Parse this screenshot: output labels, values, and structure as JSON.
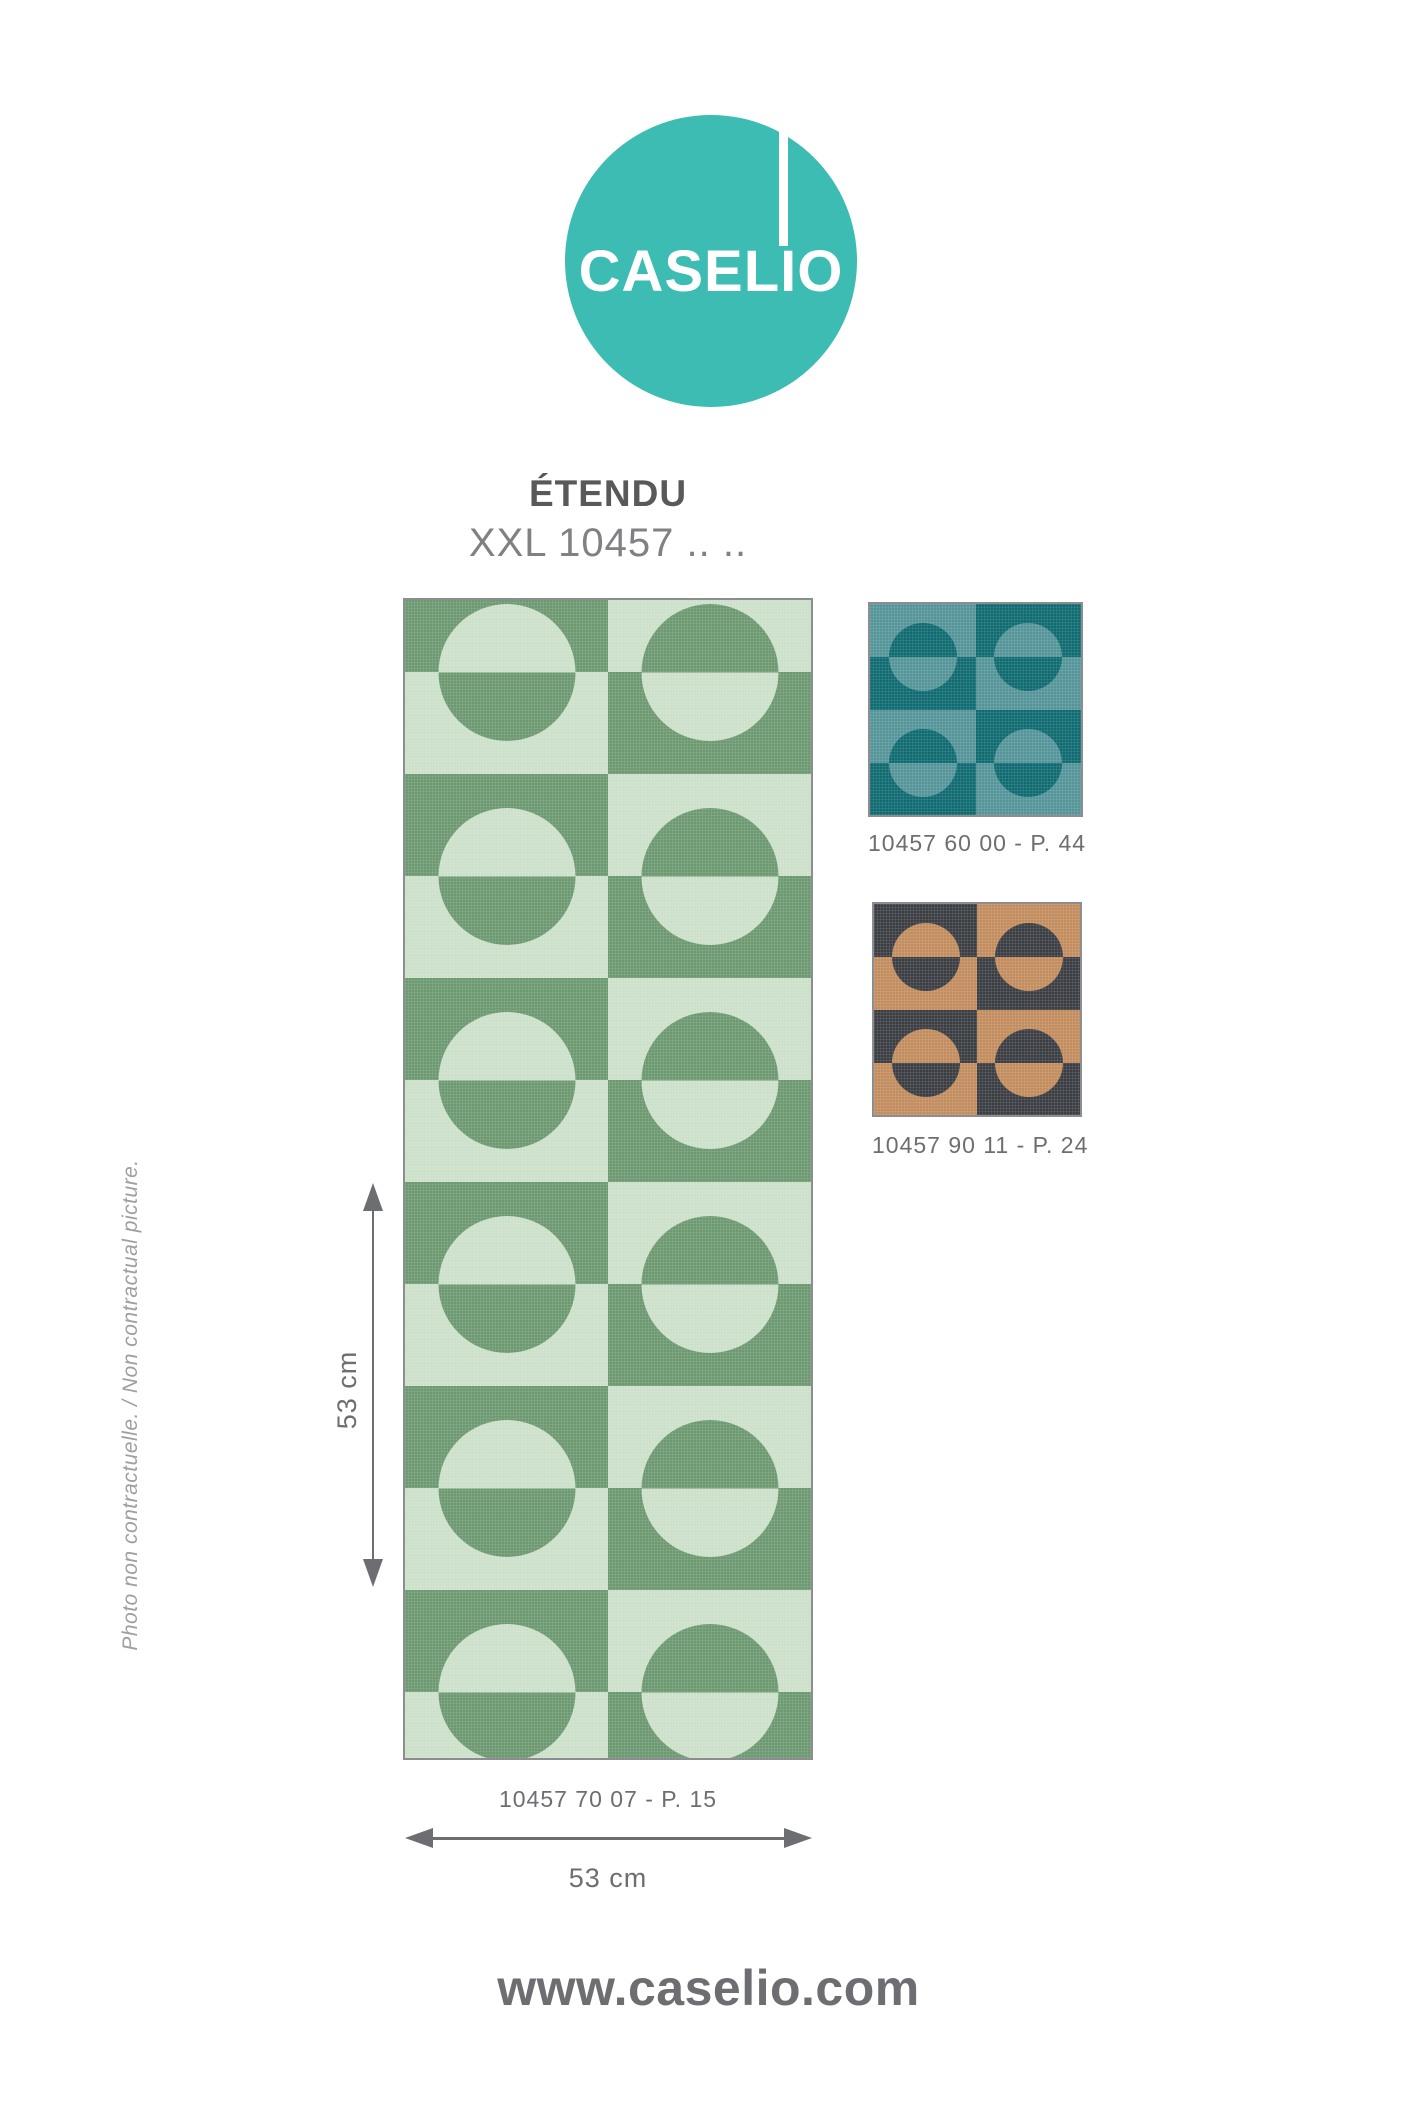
{
  "colors": {
    "logo": "#3cbcb2",
    "ink": "#58595b",
    "ink-mid": "#6d6e71",
    "ink-light": "#808184",
    "ink-faint": "#9da0a3",
    "swatch-border": "#8b8d90"
  },
  "logo": {
    "text": "CASELIO"
  },
  "header": {
    "title": "ÉTENDU",
    "reference": "XXL 10457 .. .."
  },
  "swatches": {
    "main": {
      "label": "10457 70 07 - P. 15",
      "dark": "#6d9971",
      "light": "#cce0ca",
      "pattern": {
        "columns": [
          "dark",
          "light"
        ],
        "units": 6,
        "unit_h": 204,
        "band_h": 102,
        "circle_d": 137,
        "offset_top": -30,
        "col_w": 203
      }
    },
    "teal": {
      "label": "10457 60 00 - P. 44",
      "dark": "#0f6b70",
      "light": "#55959a",
      "pattern": {
        "columns": [
          "light",
          "dark"
        ],
        "units": 2,
        "unit_h": 106,
        "band_h": 53,
        "circle_d": 68,
        "offset_top": 0,
        "col_w": 105.5
      }
    },
    "bronze": {
      "label": "10457 90 11 - P. 24",
      "dark": "#3b3e43",
      "light": "#c28d5e",
      "pattern": {
        "columns": [
          "dark",
          "light"
        ],
        "units": 2,
        "unit_h": 106,
        "band_h": 53,
        "circle_d": 68,
        "offset_top": 0,
        "col_w": 103
      }
    }
  },
  "dimensions": {
    "width_label": "53 cm",
    "height_label": "53 cm"
  },
  "disclaimer": "Photo non contractuelle. / Non contractual picture.",
  "footer": {
    "url": "www.caselio.com"
  }
}
